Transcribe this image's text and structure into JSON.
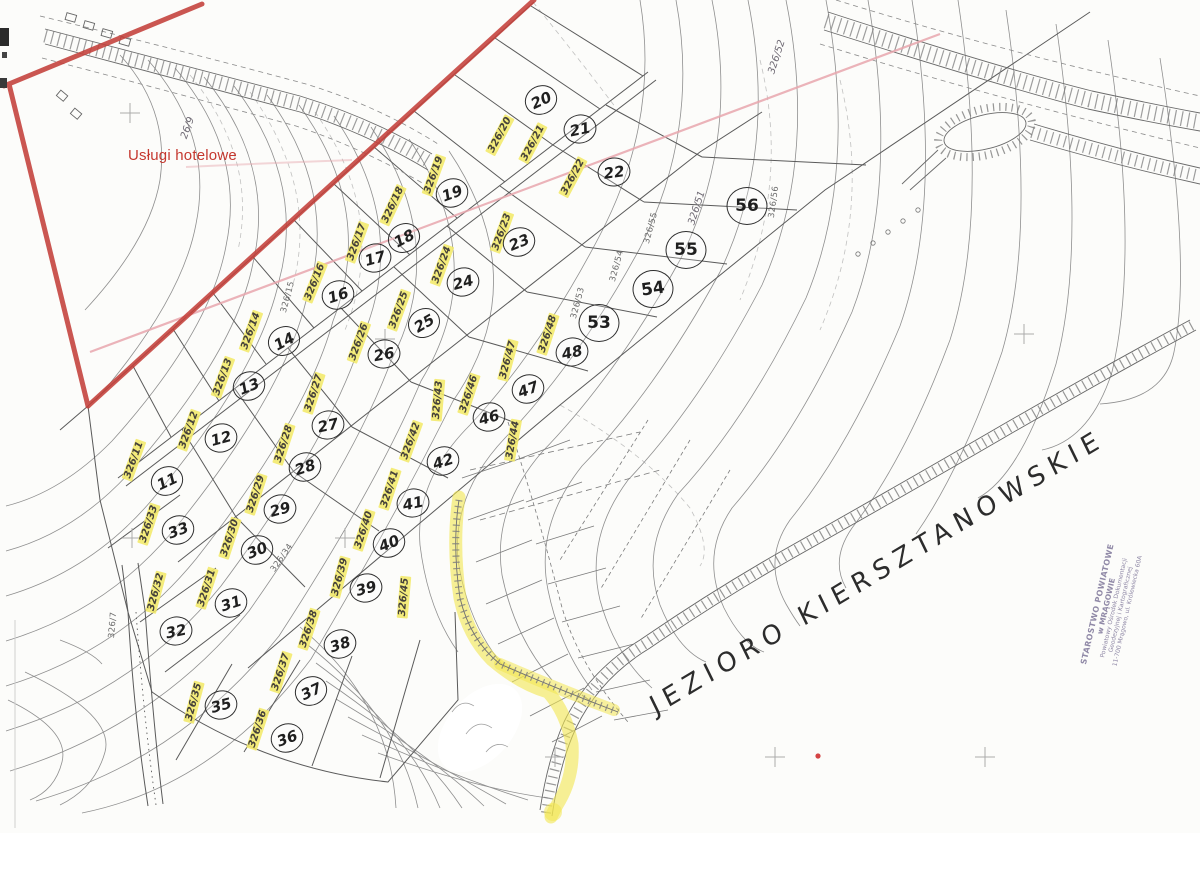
{
  "map": {
    "annotation_red_text": "Usługi hotelowe",
    "lake_label": "JEZIORO KIERSZTANOWSKIE",
    "stamp": {
      "lines": [
        "STAROSTWO POWIATOWE",
        "w MRĄGOWIE",
        "Powiatowy Ośrodek Dokumentacji",
        "Geodezyjnej i Kartograficznej",
        "11-700 Mrągowo, ul. Królewiecka 60A"
      ]
    },
    "colors": {
      "highlight": "#f3e969",
      "red_boundary": "#c4403a",
      "pink_survey": "#e7a6ad",
      "red_text": "#c5382f",
      "paper": "#fcfcfa"
    },
    "plots": [
      {
        "n": "11",
        "x": 167,
        "y": 481,
        "r": -25
      },
      {
        "n": "12",
        "x": 221,
        "y": 438,
        "r": -15
      },
      {
        "n": "13",
        "x": 249,
        "y": 386,
        "r": -22
      },
      {
        "n": "14",
        "x": 284,
        "y": 341,
        "r": -28
      },
      {
        "n": "16",
        "x": 338,
        "y": 295,
        "r": -18
      },
      {
        "n": "17",
        "x": 375,
        "y": 258,
        "r": -15
      },
      {
        "n": "18",
        "x": 404,
        "y": 238,
        "r": -28
      },
      {
        "n": "19",
        "x": 452,
        "y": 193,
        "r": -20
      },
      {
        "n": "20",
        "x": 541,
        "y": 100,
        "r": -25
      },
      {
        "n": "21",
        "x": 580,
        "y": 129,
        "r": -12
      },
      {
        "n": "22",
        "x": 614,
        "y": 172,
        "r": -8
      },
      {
        "n": "23",
        "x": 519,
        "y": 242,
        "r": -22
      },
      {
        "n": "24",
        "x": 463,
        "y": 282,
        "r": -15
      },
      {
        "n": "25",
        "x": 424,
        "y": 323,
        "r": -30
      },
      {
        "n": "26",
        "x": 384,
        "y": 354,
        "r": -10
      },
      {
        "n": "27",
        "x": 328,
        "y": 425,
        "r": -12
      },
      {
        "n": "28",
        "x": 305,
        "y": 467,
        "r": -18
      },
      {
        "n": "29",
        "x": 280,
        "y": 509,
        "r": -15
      },
      {
        "n": "30",
        "x": 257,
        "y": 550,
        "r": -22
      },
      {
        "n": "31",
        "x": 231,
        "y": 603,
        "r": -18
      },
      {
        "n": "32",
        "x": 176,
        "y": 631,
        "r": -12
      },
      {
        "n": "33",
        "x": 178,
        "y": 530,
        "r": -20
      },
      {
        "n": "35",
        "x": 221,
        "y": 705,
        "r": -15
      },
      {
        "n": "36",
        "x": 287,
        "y": 738,
        "r": -20
      },
      {
        "n": "37",
        "x": 311,
        "y": 691,
        "r": -25
      },
      {
        "n": "38",
        "x": 340,
        "y": 644,
        "r": -18
      },
      {
        "n": "39",
        "x": 366,
        "y": 588,
        "r": -15
      },
      {
        "n": "40",
        "x": 389,
        "y": 543,
        "r": -22
      },
      {
        "n": "41",
        "x": 413,
        "y": 503,
        "r": -12
      },
      {
        "n": "42",
        "x": 443,
        "y": 461,
        "r": -18
      },
      {
        "n": "46",
        "x": 489,
        "y": 417,
        "r": -15
      },
      {
        "n": "47",
        "x": 528,
        "y": 389,
        "r": -20
      },
      {
        "n": "48",
        "x": 572,
        "y": 352,
        "r": -12
      },
      {
        "n": "53",
        "x": 599,
        "y": 323,
        "r": 0,
        "big": true
      },
      {
        "n": "54",
        "x": 653,
        "y": 289,
        "r": -8,
        "big": true
      },
      {
        "n": "55",
        "x": 686,
        "y": 250,
        "r": 0,
        "big": true
      },
      {
        "n": "56",
        "x": 747,
        "y": 206,
        "r": 0,
        "big": true
      }
    ],
    "highlighted_labels": [
      {
        "t": "326/11",
        "x": 134,
        "y": 460,
        "r": -70
      },
      {
        "t": "326/12",
        "x": 189,
        "y": 430,
        "r": -70
      },
      {
        "t": "326/13",
        "x": 223,
        "y": 377,
        "r": -70
      },
      {
        "t": "326/14",
        "x": 251,
        "y": 331,
        "r": -70
      },
      {
        "t": "326/16",
        "x": 315,
        "y": 282,
        "r": -68
      },
      {
        "t": "326/17",
        "x": 357,
        "y": 242,
        "r": -70
      },
      {
        "t": "326/18",
        "x": 393,
        "y": 205,
        "r": -65
      },
      {
        "t": "326/19",
        "x": 434,
        "y": 175,
        "r": -70
      },
      {
        "t": "326/20",
        "x": 500,
        "y": 135,
        "r": -62
      },
      {
        "t": "326/21",
        "x": 533,
        "y": 143,
        "r": -62
      },
      {
        "t": "326/22",
        "x": 573,
        "y": 177,
        "r": -62
      },
      {
        "t": "326/23",
        "x": 502,
        "y": 232,
        "r": -70
      },
      {
        "t": "326/24",
        "x": 442,
        "y": 265,
        "r": -70
      },
      {
        "t": "326/25",
        "x": 399,
        "y": 310,
        "r": -70
      },
      {
        "t": "326/26",
        "x": 359,
        "y": 342,
        "r": -70
      },
      {
        "t": "326/27",
        "x": 314,
        "y": 393,
        "r": -72
      },
      {
        "t": "326/28",
        "x": 284,
        "y": 444,
        "r": -72
      },
      {
        "t": "326/29",
        "x": 256,
        "y": 494,
        "r": -72
      },
      {
        "t": "326/30",
        "x": 230,
        "y": 538,
        "r": -72
      },
      {
        "t": "326/31",
        "x": 207,
        "y": 588,
        "r": -72
      },
      {
        "t": "326/32",
        "x": 156,
        "y": 592,
        "r": -75
      },
      {
        "t": "326/33",
        "x": 149,
        "y": 524,
        "r": -72
      },
      {
        "t": "326/35",
        "x": 194,
        "y": 702,
        "r": -75
      },
      {
        "t": "326/36",
        "x": 258,
        "y": 729,
        "r": -72
      },
      {
        "t": "326/37",
        "x": 281,
        "y": 672,
        "r": -72
      },
      {
        "t": "326/38",
        "x": 309,
        "y": 629,
        "r": -72
      },
      {
        "t": "326/39",
        "x": 340,
        "y": 577,
        "r": -75
      },
      {
        "t": "326/40",
        "x": 364,
        "y": 530,
        "r": -72
      },
      {
        "t": "326/41",
        "x": 390,
        "y": 489,
        "r": -72
      },
      {
        "t": "326/42",
        "x": 411,
        "y": 441,
        "r": -70
      },
      {
        "t": "326/43",
        "x": 438,
        "y": 400,
        "r": -85
      },
      {
        "t": "326/44",
        "x": 513,
        "y": 440,
        "r": -80
      },
      {
        "t": "326/45",
        "x": 404,
        "y": 597,
        "r": -85
      },
      {
        "t": "326/46",
        "x": 469,
        "y": 394,
        "r": -72
      },
      {
        "t": "326/47",
        "x": 508,
        "y": 360,
        "r": -75
      },
      {
        "t": "326/48",
        "x": 548,
        "y": 334,
        "r": -72
      }
    ],
    "printed_labels": [
      {
        "t": "326/53",
        "x": 578,
        "y": 303,
        "r": -75
      },
      {
        "t": "326/54",
        "x": 617,
        "y": 266,
        "r": -75
      },
      {
        "t": "326/55",
        "x": 651,
        "y": 228,
        "r": -75
      },
      {
        "t": "326/56",
        "x": 774,
        "y": 202,
        "r": -82
      },
      {
        "t": "326/34",
        "x": 282,
        "y": 558,
        "r": -55
      },
      {
        "t": "326/15",
        "x": 288,
        "y": 297,
        "r": -75
      },
      {
        "t": "326/7",
        "x": 113,
        "y": 625,
        "r": -85
      }
    ],
    "hand_labels": [
      {
        "t": "326/51",
        "x": 697,
        "y": 208,
        "r": -72
      },
      {
        "t": "326/52",
        "x": 777,
        "y": 57,
        "r": -72
      },
      {
        "t": "26/9",
        "x": 188,
        "y": 128,
        "r": -70
      }
    ]
  }
}
